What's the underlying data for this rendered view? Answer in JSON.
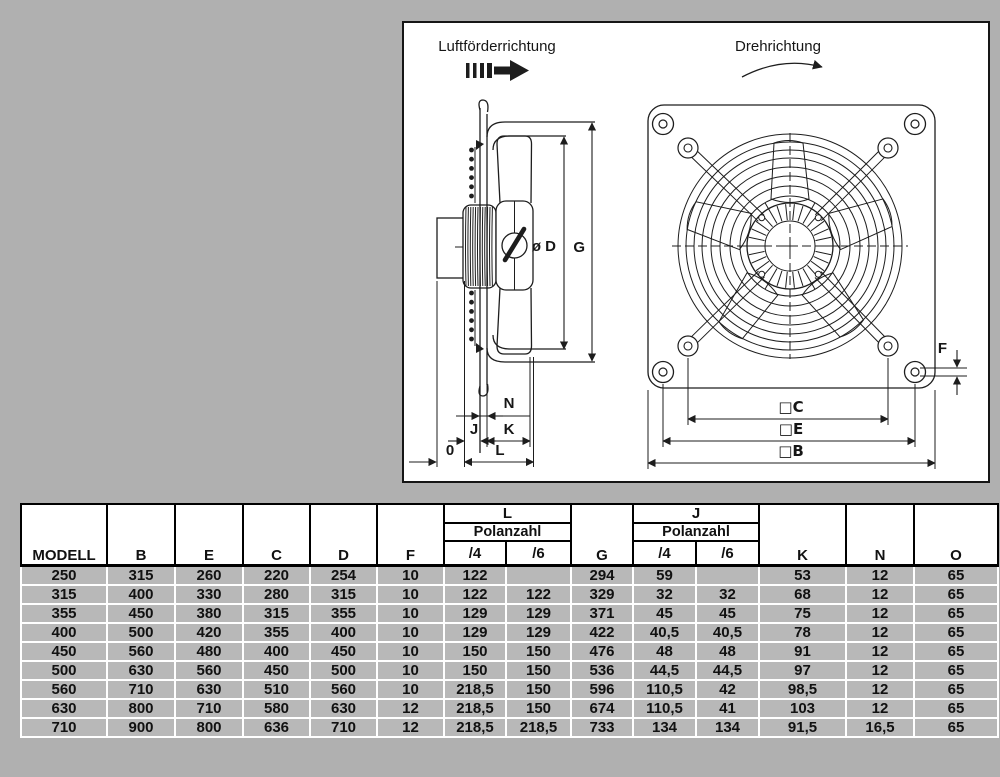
{
  "drawing": {
    "airflow_label": "Luftförderrichtung",
    "rotation_label": "Drehrichtung",
    "dims": {
      "diameter": "ø D",
      "g": "G",
      "n": "N",
      "j": "J",
      "k": "K",
      "o": "0",
      "l": "L",
      "f": "F",
      "sq_c": "□C",
      "sq_e": "□E",
      "sq_b": "□B"
    }
  },
  "table": {
    "headers": {
      "modell": "MODELL",
      "b": "B",
      "e": "E",
      "c": "C",
      "d": "D",
      "f": "F",
      "l": "L",
      "g": "G",
      "j": "J",
      "polanzahl": "Polanzahl",
      "p4": "/4",
      "p6": "/6",
      "k": "K",
      "n": "N",
      "o": "O"
    },
    "rows": [
      [
        "250",
        "315",
        "260",
        "220",
        "254",
        "10",
        "122",
        "",
        "294",
        "59",
        "",
        "53",
        "12",
        "65"
      ],
      [
        "315",
        "400",
        "330",
        "280",
        "315",
        "10",
        "122",
        "122",
        "329",
        "32",
        "32",
        "68",
        "12",
        "65"
      ],
      [
        "355",
        "450",
        "380",
        "315",
        "355",
        "10",
        "129",
        "129",
        "371",
        "45",
        "45",
        "75",
        "12",
        "65"
      ],
      [
        "400",
        "500",
        "420",
        "355",
        "400",
        "10",
        "129",
        "129",
        "422",
        "40,5",
        "40,5",
        "78",
        "12",
        "65"
      ],
      [
        "450",
        "560",
        "480",
        "400",
        "450",
        "10",
        "150",
        "150",
        "476",
        "48",
        "48",
        "91",
        "12",
        "65"
      ],
      [
        "500",
        "630",
        "560",
        "450",
        "500",
        "10",
        "150",
        "150",
        "536",
        "44,5",
        "44,5",
        "97",
        "12",
        "65"
      ],
      [
        "560",
        "710",
        "630",
        "510",
        "560",
        "10",
        "218,5",
        "150",
        "596",
        "110,5",
        "42",
        "98,5",
        "12",
        "65"
      ],
      [
        "630",
        "800",
        "710",
        "580",
        "630",
        "12",
        "218,5",
        "150",
        "674",
        "110,5",
        "41",
        "103",
        "12",
        "65"
      ],
      [
        "710",
        "900",
        "800",
        "636",
        "710",
        "12",
        "218,5",
        "218,5",
        "733",
        "134",
        "134",
        "91,5",
        "16,5",
        "65"
      ]
    ]
  },
  "colors": {
    "background": "#b0b0b0",
    "panel": "#ffffff",
    "line": "#1d1d1d",
    "cell": "#b8b8b8"
  }
}
